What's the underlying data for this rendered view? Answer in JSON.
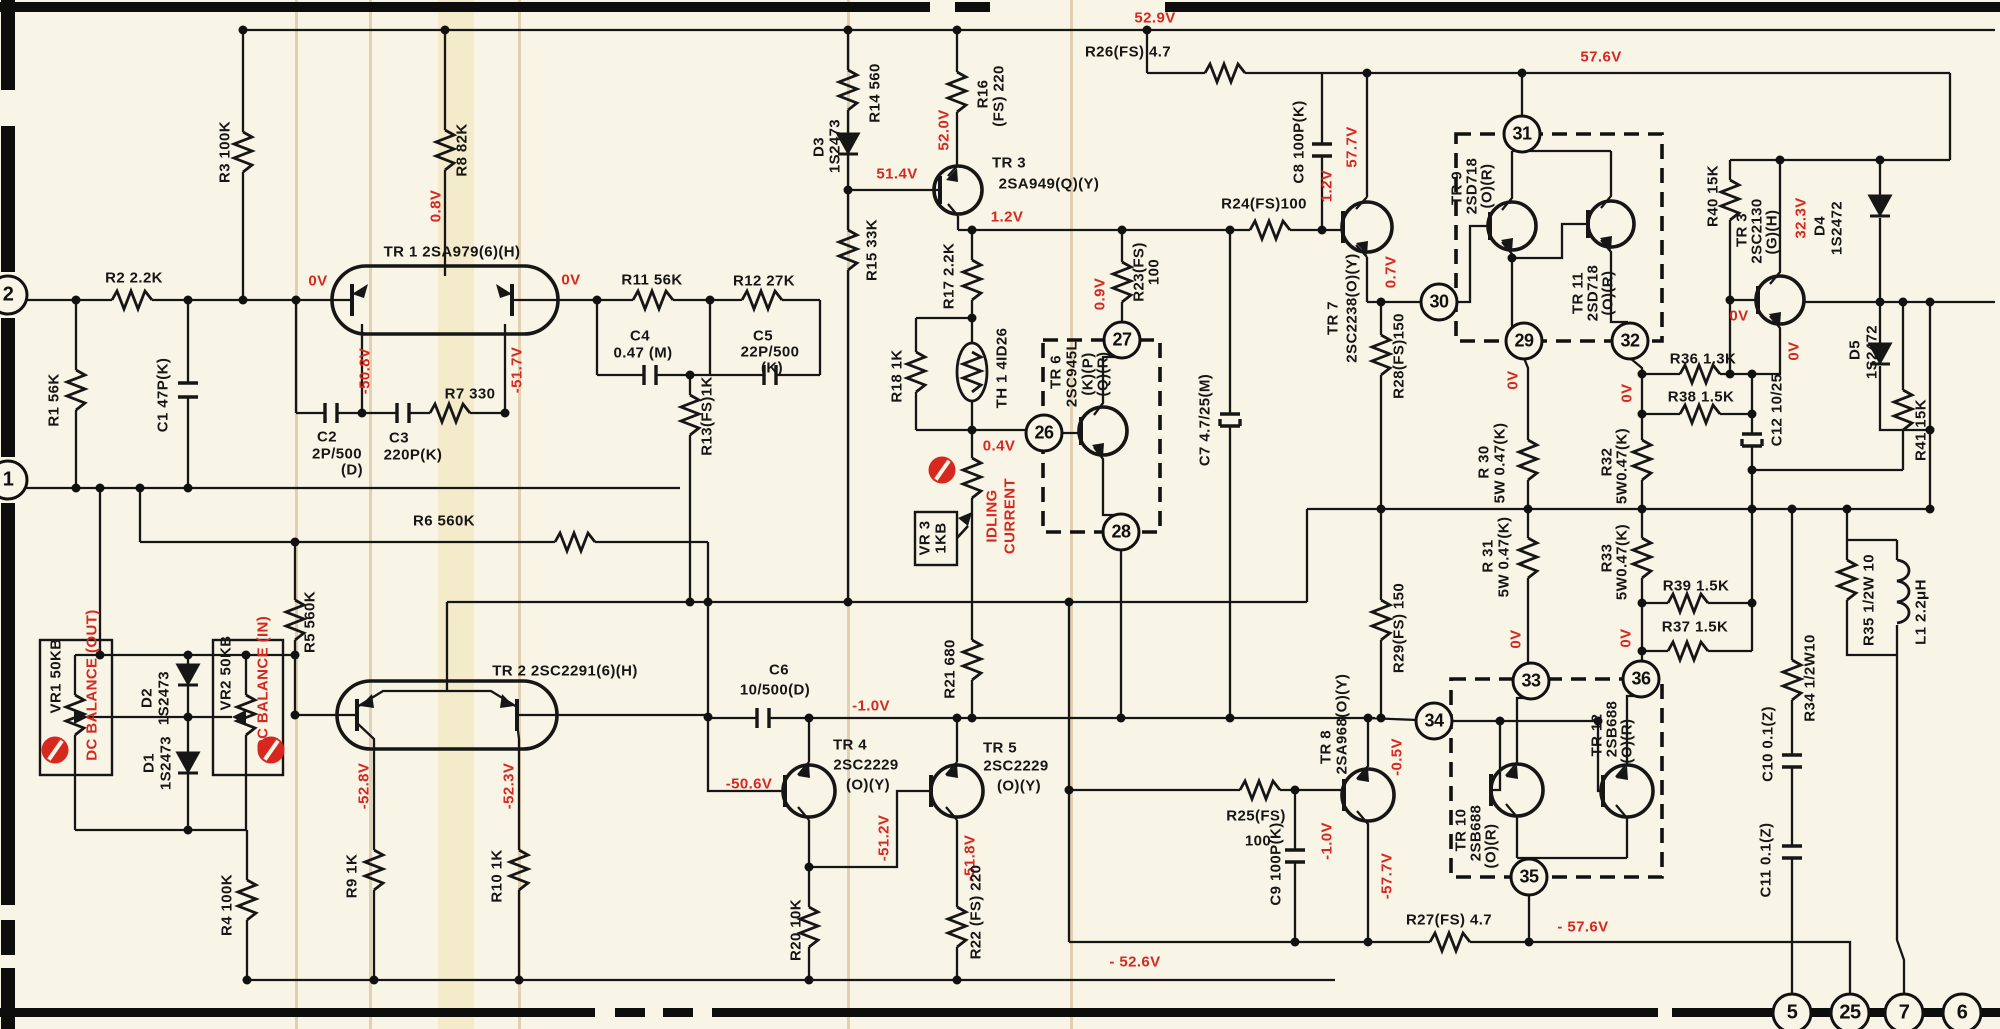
{
  "meta": {
    "type": "schematic-diagram",
    "subject": "Power amplifier circuit schematic (left channel)",
    "paper_color": "#f8f4e6",
    "ink_color": "#161616",
    "voltage_color": "#d6281e"
  },
  "schematic": {
    "labels": [
      {
        "t": "R2 2.2K",
        "x": 134,
        "y": 278,
        "v": 0,
        "c": "k"
      },
      {
        "t": "R1 56K",
        "x": 54,
        "y": 400,
        "v": 1,
        "c": "k"
      },
      {
        "t": "C1 47P(K)",
        "x": 163,
        "y": 395,
        "v": 1,
        "c": "k"
      },
      {
        "t": "R3 100K",
        "x": 225,
        "y": 152,
        "v": 1,
        "c": "k"
      },
      {
        "t": "R8 82K",
        "x": 462,
        "y": 150,
        "v": 1,
        "c": "k"
      },
      {
        "t": "0.8V",
        "x": 436,
        "y": 206,
        "v": 1,
        "c": "r"
      },
      {
        "t": "TR 1  2SA979(6)(H)",
        "x": 452,
        "y": 252,
        "v": 0,
        "c": "k"
      },
      {
        "t": "0V",
        "x": 318,
        "y": 281,
        "v": 0,
        "c": "r"
      },
      {
        "t": "0V",
        "x": 571,
        "y": 280,
        "v": 0,
        "c": "r"
      },
      {
        "t": "-50.8V",
        "x": 365,
        "y": 371,
        "v": 1,
        "c": "r"
      },
      {
        "t": "-51.7V",
        "x": 517,
        "y": 370,
        "v": 1,
        "c": "r"
      },
      {
        "t": "R11 56K",
        "x": 652,
        "y": 280,
        "v": 0,
        "c": "k"
      },
      {
        "t": "R12 27K",
        "x": 764,
        "y": 281,
        "v": 0,
        "c": "k"
      },
      {
        "t": "C4",
        "x": 640,
        "y": 336,
        "v": 0,
        "c": "k"
      },
      {
        "t": "0.47 (M)",
        "x": 643,
        "y": 353,
        "v": 0,
        "c": "k"
      },
      {
        "t": "C5",
        "x": 763,
        "y": 336,
        "v": 0,
        "c": "k"
      },
      {
        "t": "22P/500",
        "x": 770,
        "y": 352,
        "v": 0,
        "c": "k"
      },
      {
        "t": "(K)",
        "x": 772,
        "y": 368,
        "v": 0,
        "c": "k"
      },
      {
        "t": "R7 330",
        "x": 470,
        "y": 394,
        "v": 0,
        "c": "k"
      },
      {
        "t": "C2",
        "x": 327,
        "y": 437,
        "v": 0,
        "c": "k"
      },
      {
        "t": "2P/500",
        "x": 337,
        "y": 454,
        "v": 0,
        "c": "k"
      },
      {
        "t": "(D)",
        "x": 352,
        "y": 470,
        "v": 0,
        "c": "k"
      },
      {
        "t": "C3",
        "x": 399,
        "y": 438,
        "v": 0,
        "c": "k"
      },
      {
        "t": "220P(K)",
        "x": 413,
        "y": 455,
        "v": 0,
        "c": "k"
      },
      {
        "t": "R13(FS)1K",
        "x": 707,
        "y": 416,
        "v": 1,
        "c": "k"
      },
      {
        "t": "R6 560K",
        "x": 444,
        "y": 521,
        "v": 0,
        "c": "k"
      },
      {
        "t": "R5 560K",
        "x": 310,
        "y": 622,
        "v": 1,
        "c": "k"
      },
      {
        "t": "VR1 50KB",
        "x": 56,
        "y": 676,
        "v": 1,
        "c": "k"
      },
      {
        "t": "DC BALANCE (OUT)",
        "x": 92,
        "y": 685,
        "v": 1,
        "c": "r"
      },
      {
        "t": "D2",
        "x": 147,
        "y": 698,
        "v": 1,
        "c": "k"
      },
      {
        "t": "1S2473",
        "x": 164,
        "y": 698,
        "v": 1,
        "c": "k"
      },
      {
        "t": "VR2 50KB",
        "x": 226,
        "y": 673,
        "v": 1,
        "c": "k"
      },
      {
        "t": "DC BALANCE (IN)",
        "x": 263,
        "y": 683,
        "v": 1,
        "c": "r"
      },
      {
        "t": "D1",
        "x": 149,
        "y": 763,
        "v": 1,
        "c": "k"
      },
      {
        "t": "1S2473",
        "x": 166,
        "y": 763,
        "v": 1,
        "c": "k"
      },
      {
        "t": "R4 100K",
        "x": 227,
        "y": 905,
        "v": 1,
        "c": "k"
      },
      {
        "t": "TR 2  2SC2291(6)(H)",
        "x": 565,
        "y": 671,
        "v": 0,
        "c": "k"
      },
      {
        "t": "-52.8V",
        "x": 364,
        "y": 786,
        "v": 1,
        "c": "r"
      },
      {
        "t": "-52.3V",
        "x": 509,
        "y": 786,
        "v": 1,
        "c": "r"
      },
      {
        "t": "R9 1K",
        "x": 352,
        "y": 876,
        "v": 1,
        "c": "k"
      },
      {
        "t": "R10 1K",
        "x": 497,
        "y": 876,
        "v": 1,
        "c": "k"
      },
      {
        "t": "C6",
        "x": 779,
        "y": 670,
        "v": 0,
        "c": "k"
      },
      {
        "t": "10/500(D)",
        "x": 775,
        "y": 690,
        "v": 0,
        "c": "k"
      },
      {
        "t": "-1.0V",
        "x": 871,
        "y": 706,
        "v": 0,
        "c": "r"
      },
      {
        "t": "-50.6V",
        "x": 749,
        "y": 784,
        "v": 0,
        "c": "r"
      },
      {
        "t": "TR 4",
        "x": 850,
        "y": 745,
        "v": 0,
        "c": "k"
      },
      {
        "t": "2SC2229",
        "x": 866,
        "y": 765,
        "v": 0,
        "c": "k"
      },
      {
        "t": "(O)(Y)",
        "x": 868,
        "y": 785,
        "v": 0,
        "c": "k"
      },
      {
        "t": "TR 5",
        "x": 1000,
        "y": 748,
        "v": 0,
        "c": "k"
      },
      {
        "t": "2SC2229",
        "x": 1016,
        "y": 766,
        "v": 0,
        "c": "k"
      },
      {
        "t": "(O)(Y)",
        "x": 1019,
        "y": 786,
        "v": 0,
        "c": "k"
      },
      {
        "t": "-51.2V",
        "x": 884,
        "y": 838,
        "v": 1,
        "c": "r"
      },
      {
        "t": "-51.8V",
        "x": 970,
        "y": 858,
        "v": 1,
        "c": "r"
      },
      {
        "t": "R20 10K",
        "x": 796,
        "y": 930,
        "v": 1,
        "c": "k"
      },
      {
        "t": "R22 (FS) 220",
        "x": 976,
        "y": 912,
        "v": 1,
        "c": "k"
      },
      {
        "t": "R21 680",
        "x": 950,
        "y": 669,
        "v": 1,
        "c": "k"
      },
      {
        "t": "- 52.6V",
        "x": 1135,
        "y": 962,
        "v": 0,
        "c": "r"
      },
      {
        "t": "52.9V",
        "x": 1155,
        "y": 18,
        "v": 0,
        "c": "r"
      },
      {
        "t": "D3",
        "x": 819,
        "y": 147,
        "v": 1,
        "c": "k"
      },
      {
        "t": "1S2473",
        "x": 835,
        "y": 146,
        "v": 1,
        "c": "k"
      },
      {
        "t": "R14 560",
        "x": 875,
        "y": 93,
        "v": 1,
        "c": "k"
      },
      {
        "t": "R15 33K",
        "x": 872,
        "y": 250,
        "v": 1,
        "c": "k"
      },
      {
        "t": "R16",
        "x": 983,
        "y": 94,
        "v": 1,
        "c": "k"
      },
      {
        "t": "(FS) 220",
        "x": 999,
        "y": 96,
        "v": 1,
        "c": "k"
      },
      {
        "t": "52.0V",
        "x": 944,
        "y": 130,
        "v": 1,
        "c": "r"
      },
      {
        "t": "51.4V",
        "x": 897,
        "y": 174,
        "v": 0,
        "c": "r"
      },
      {
        "t": "TR 3",
        "x": 1009,
        "y": 163,
        "v": 0,
        "c": "k"
      },
      {
        "t": "2SA949(Q)(Y)",
        "x": 1049,
        "y": 184,
        "v": 0,
        "c": "k"
      },
      {
        "t": "1.2V",
        "x": 1007,
        "y": 217,
        "v": 0,
        "c": "r"
      },
      {
        "t": "R17 2.2K",
        "x": 949,
        "y": 276,
        "v": 1,
        "c": "k"
      },
      {
        "t": "R18 1K",
        "x": 897,
        "y": 376,
        "v": 1,
        "c": "k"
      },
      {
        "t": "TH 1 4ID26",
        "x": 1002,
        "y": 368,
        "v": 1,
        "c": "k"
      },
      {
        "t": "0.4V",
        "x": 999,
        "y": 446,
        "v": 0,
        "c": "r"
      },
      {
        "t": "VR 3",
        "x": 925,
        "y": 538,
        "v": 1,
        "c": "k"
      },
      {
        "t": "1KB",
        "x": 941,
        "y": 538,
        "v": 1,
        "c": "k"
      },
      {
        "t": "IDLING",
        "x": 992,
        "y": 516,
        "v": 1,
        "c": "r"
      },
      {
        "t": "CURRENT",
        "x": 1010,
        "y": 516,
        "v": 1,
        "c": "r"
      },
      {
        "t": "TR 6",
        "x": 1056,
        "y": 372,
        "v": 1,
        "c": "k"
      },
      {
        "t": "2SC945L",
        "x": 1072,
        "y": 374,
        "v": 1,
        "c": "k"
      },
      {
        "t": "(K)(P)",
        "x": 1088,
        "y": 374,
        "v": 1,
        "c": "k"
      },
      {
        "t": "(Q)(R)",
        "x": 1103,
        "y": 374,
        "v": 1,
        "c": "k"
      },
      {
        "t": "0.9V",
        "x": 1100,
        "y": 294,
        "v": 1,
        "c": "r"
      },
      {
        "t": "R23(FS)",
        "x": 1139,
        "y": 272,
        "v": 1,
        "c": "k"
      },
      {
        "t": "100",
        "x": 1154,
        "y": 272,
        "v": 1,
        "c": "k"
      },
      {
        "t": "C7 4.7/25(M)",
        "x": 1205,
        "y": 420,
        "v": 1,
        "c": "k"
      },
      {
        "t": "R24(FS)100",
        "x": 1264,
        "y": 204,
        "v": 0,
        "c": "k"
      },
      {
        "t": "C8 100P(K)",
        "x": 1299,
        "y": 142,
        "v": 1,
        "c": "k"
      },
      {
        "t": "R26(FS) 4.7",
        "x": 1128,
        "y": 52,
        "v": 0,
        "c": "k"
      },
      {
        "t": "57.6V",
        "x": 1601,
        "y": 57,
        "v": 0,
        "c": "r"
      },
      {
        "t": "1.2V",
        "x": 1327,
        "y": 186,
        "v": 1,
        "c": "r"
      },
      {
        "t": "57.7V",
        "x": 1352,
        "y": 147,
        "v": 1,
        "c": "r"
      },
      {
        "t": "TR 7",
        "x": 1333,
        "y": 318,
        "v": 1,
        "c": "k"
      },
      {
        "t": "2SC2238(O)(Y)",
        "x": 1352,
        "y": 308,
        "v": 1,
        "c": "k"
      },
      {
        "t": "0.7V",
        "x": 1391,
        "y": 272,
        "v": 1,
        "c": "r"
      },
      {
        "t": "R28(FS)150",
        "x": 1399,
        "y": 356,
        "v": 1,
        "c": "k"
      },
      {
        "t": "R29(FS) 150",
        "x": 1399,
        "y": 628,
        "v": 1,
        "c": "k"
      },
      {
        "t": "TR 9",
        "x": 1457,
        "y": 188,
        "v": 1,
        "c": "k"
      },
      {
        "t": "2SD718",
        "x": 1472,
        "y": 186,
        "v": 1,
        "c": "k"
      },
      {
        "t": "(O)(R)",
        "x": 1487,
        "y": 186,
        "v": 1,
        "c": "k"
      },
      {
        "t": "TR 11",
        "x": 1578,
        "y": 293,
        "v": 1,
        "c": "k"
      },
      {
        "t": "2SD718",
        "x": 1593,
        "y": 293,
        "v": 1,
        "c": "k"
      },
      {
        "t": "(O)(R)",
        "x": 1608,
        "y": 293,
        "v": 1,
        "c": "k"
      },
      {
        "t": "0V",
        "x": 1513,
        "y": 380,
        "v": 1,
        "c": "r"
      },
      {
        "t": "0V",
        "x": 1627,
        "y": 393,
        "v": 1,
        "c": "r"
      },
      {
        "t": "R 30",
        "x": 1484,
        "y": 462,
        "v": 1,
        "c": "k"
      },
      {
        "t": "5W 0.47(K)",
        "x": 1500,
        "y": 463,
        "v": 1,
        "c": "k"
      },
      {
        "t": "R 31",
        "x": 1488,
        "y": 556,
        "v": 1,
        "c": "k"
      },
      {
        "t": "5W 0.47(K)",
        "x": 1504,
        "y": 557,
        "v": 1,
        "c": "k"
      },
      {
        "t": "R32",
        "x": 1607,
        "y": 462,
        "v": 1,
        "c": "k"
      },
      {
        "t": "5W0.47(K)",
        "x": 1622,
        "y": 466,
        "v": 1,
        "c": "k"
      },
      {
        "t": "R33",
        "x": 1607,
        "y": 558,
        "v": 1,
        "c": "k"
      },
      {
        "t": "5W0.47(K)",
        "x": 1622,
        "y": 562,
        "v": 1,
        "c": "k"
      },
      {
        "t": "0V",
        "x": 1516,
        "y": 639,
        "v": 1,
        "c": "r"
      },
      {
        "t": "0V",
        "x": 1626,
        "y": 638,
        "v": 1,
        "c": "r"
      },
      {
        "t": "R36 1.3K",
        "x": 1703,
        "y": 359,
        "v": 0,
        "c": "k"
      },
      {
        "t": "R38 1.5K",
        "x": 1701,
        "y": 397,
        "v": 0,
        "c": "k"
      },
      {
        "t": "R39 1.5K",
        "x": 1696,
        "y": 586,
        "v": 0,
        "c": "k"
      },
      {
        "t": "R37 1.5K",
        "x": 1695,
        "y": 627,
        "v": 0,
        "c": "k"
      },
      {
        "t": "R40 15K",
        "x": 1713,
        "y": 196,
        "v": 1,
        "c": "k"
      },
      {
        "t": "TR 3",
        "x": 1742,
        "y": 230,
        "v": 1,
        "c": "k"
      },
      {
        "t": "2SC2130",
        "x": 1757,
        "y": 231,
        "v": 1,
        "c": "k"
      },
      {
        "t": "(G)(H)",
        "x": 1772,
        "y": 232,
        "v": 1,
        "c": "k"
      },
      {
        "t": "32.3V",
        "x": 1801,
        "y": 218,
        "v": 1,
        "c": "r"
      },
      {
        "t": "0V",
        "x": 1739,
        "y": 316,
        "v": 0,
        "c": "r"
      },
      {
        "t": "0V",
        "x": 1794,
        "y": 351,
        "v": 1,
        "c": "r"
      },
      {
        "t": "D4",
        "x": 1820,
        "y": 226,
        "v": 1,
        "c": "k"
      },
      {
        "t": "1S2472",
        "x": 1837,
        "y": 228,
        "v": 1,
        "c": "k"
      },
      {
        "t": "D5",
        "x": 1855,
        "y": 350,
        "v": 1,
        "c": "k"
      },
      {
        "t": "1S2472",
        "x": 1872,
        "y": 352,
        "v": 1,
        "c": "k"
      },
      {
        "t": "R41 15K",
        "x": 1921,
        "y": 430,
        "v": 1,
        "c": "k"
      },
      {
        "t": "C12 10/25",
        "x": 1777,
        "y": 410,
        "v": 1,
        "c": "k"
      },
      {
        "t": "R34 1/2W10",
        "x": 1810,
        "y": 678,
        "v": 1,
        "c": "k"
      },
      {
        "t": "C10 0.1(Z)",
        "x": 1768,
        "y": 744,
        "v": 1,
        "c": "k"
      },
      {
        "t": "C11 0.1(Z)",
        "x": 1766,
        "y": 860,
        "v": 1,
        "c": "k"
      },
      {
        "t": "R35 1/2W 10",
        "x": 1869,
        "y": 600,
        "v": 1,
        "c": "k"
      },
      {
        "t": "L1 2.2μH",
        "x": 1921,
        "y": 612,
        "v": 1,
        "c": "k"
      },
      {
        "t": "R25(FS)",
        "x": 1256,
        "y": 816,
        "v": 0,
        "c": "k"
      },
      {
        "t": "100",
        "x": 1258,
        "y": 841,
        "v": 0,
        "c": "k"
      },
      {
        "t": "TR 8",
        "x": 1326,
        "y": 747,
        "v": 1,
        "c": "k"
      },
      {
        "t": "2SA968(O)(Y)",
        "x": 1342,
        "y": 724,
        "v": 1,
        "c": "k"
      },
      {
        "t": "-0.5V",
        "x": 1397,
        "y": 757,
        "v": 1,
        "c": "r"
      },
      {
        "t": "-1.0V",
        "x": 1327,
        "y": 841,
        "v": 1,
        "c": "r"
      },
      {
        "t": "-57.7V",
        "x": 1387,
        "y": 876,
        "v": 1,
        "c": "r"
      },
      {
        "t": "C9 100P(K)",
        "x": 1276,
        "y": 864,
        "v": 1,
        "c": "k"
      },
      {
        "t": "R27(FS) 4.7",
        "x": 1449,
        "y": 920,
        "v": 0,
        "c": "k"
      },
      {
        "t": "- 57.6V",
        "x": 1583,
        "y": 927,
        "v": 0,
        "c": "r"
      },
      {
        "t": "TR 10",
        "x": 1461,
        "y": 830,
        "v": 1,
        "c": "k"
      },
      {
        "t": "2SB688",
        "x": 1476,
        "y": 833,
        "v": 1,
        "c": "k"
      },
      {
        "t": "(O)(R)",
        "x": 1491,
        "y": 846,
        "v": 1,
        "c": "k"
      },
      {
        "t": "TR 12",
        "x": 1597,
        "y": 735,
        "v": 1,
        "c": "k"
      },
      {
        "t": "2SB688",
        "x": 1612,
        "y": 729,
        "v": 1,
        "c": "k"
      },
      {
        "t": "(O)(R)",
        "x": 1627,
        "y": 741,
        "v": 1,
        "c": "k"
      }
    ],
    "circle_nodes": [
      {
        "n": "26",
        "x": 1044,
        "y": 433
      },
      {
        "n": "27",
        "x": 1122,
        "y": 340
      },
      {
        "n": "28",
        "x": 1121,
        "y": 532
      },
      {
        "n": "29",
        "x": 1524,
        "y": 341
      },
      {
        "n": "30",
        "x": 1439,
        "y": 302
      },
      {
        "n": "31",
        "x": 1522,
        "y": 134
      },
      {
        "n": "32",
        "x": 1630,
        "y": 341
      },
      {
        "n": "33",
        "x": 1531,
        "y": 681
      },
      {
        "n": "34",
        "x": 1434,
        "y": 721
      },
      {
        "n": "35",
        "x": 1529,
        "y": 877
      },
      {
        "n": "36",
        "x": 1641,
        "y": 679
      }
    ],
    "terminals": [
      {
        "n": "2",
        "x": 8,
        "y": 295
      },
      {
        "n": "1",
        "x": 8,
        "y": 480
      },
      {
        "n": "5",
        "x": 1792,
        "y": 1013
      },
      {
        "n": "25",
        "x": 1850,
        "y": 1013
      },
      {
        "n": "7",
        "x": 1904,
        "y": 1013
      },
      {
        "n": "6",
        "x": 1962,
        "y": 1013
      }
    ],
    "adjust_marks": [
      {
        "x": 55,
        "y": 750
      },
      {
        "x": 271,
        "y": 750
      },
      {
        "x": 942,
        "y": 470
      }
    ]
  }
}
